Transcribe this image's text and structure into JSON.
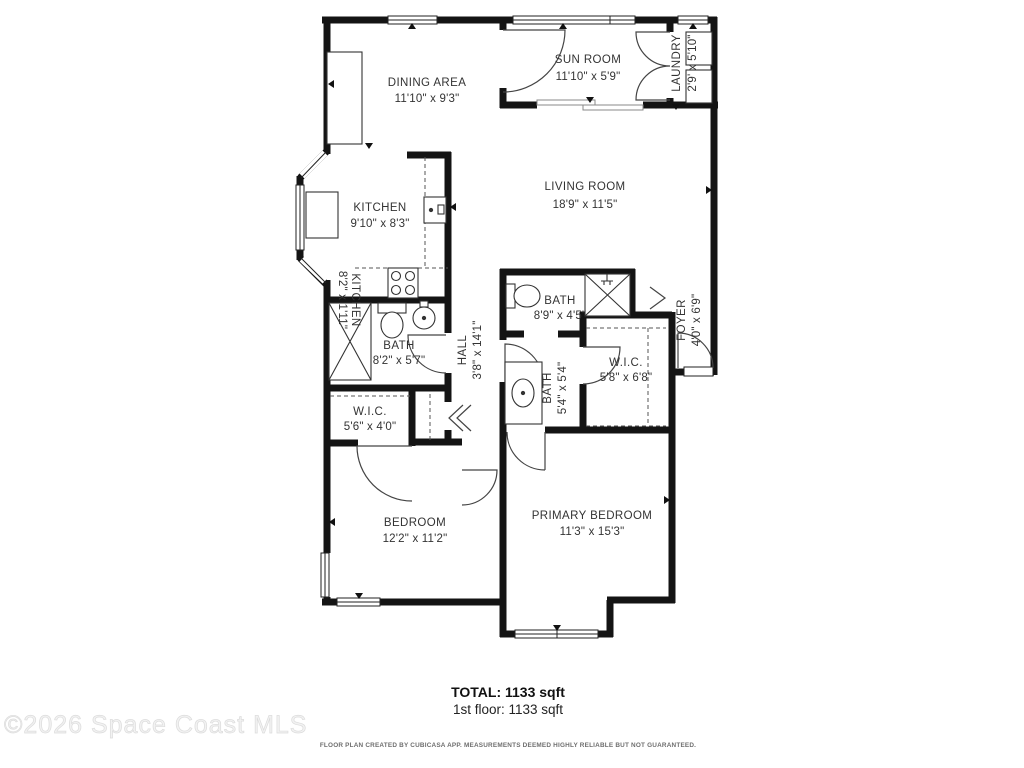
{
  "rooms": {
    "dining": {
      "name": "DINING AREA",
      "dims": "11'10\" x 9'3\""
    },
    "sunroom": {
      "name": "SUN ROOM",
      "dims": "11'10\" x 5'9\""
    },
    "laundry": {
      "name": "LAUNDRY",
      "dims": "2'9' x 5'10\""
    },
    "living": {
      "name": "LIVING ROOM",
      "dims": "18'9\" x 11'5\""
    },
    "kitchen": {
      "name": "KITCHEN",
      "dims": "9'10\" x 8'3\""
    },
    "kitchen_strip": {
      "name": "KITCHEN",
      "dims": "8'2\" x 1'11\""
    },
    "bath1": {
      "name": "BATH",
      "dims": "8'2\" x 5'7\""
    },
    "bath2": {
      "name": "BATH",
      "dims": "8'9\" x 4'5\""
    },
    "bath3": {
      "name": "BATH",
      "dims": "5'4\" x 5'4\""
    },
    "hall": {
      "name": "HALL",
      "dims": "3'8\" x 14'1\""
    },
    "foyer": {
      "name": "FOYER",
      "dims": "4'0\" x 6'9\""
    },
    "wic1": {
      "name": "W.I.C.",
      "dims": "5'6\" x 4'0\""
    },
    "wic2": {
      "name": "W.I.C.",
      "dims": "5'8\" x 6'8\""
    },
    "bedroom": {
      "name": "BEDROOM",
      "dims": "12'2\" x 11'2\""
    },
    "primary": {
      "name": "PRIMARY BEDROOM",
      "dims": "11'3\" x 15'3\""
    }
  },
  "summary": {
    "total": "TOTAL:  1133 sqft",
    "floor": "1st floor:  1133 sqft"
  },
  "footer": "FLOOR PLAN CREATED BY CUBICASA APP. MEASUREMENTS DEEMED HIGHLY RELIABLE BUT NOT GUARANTEED.",
  "watermark": "©2026 Space Coast MLS",
  "colors": {
    "wall": "#141414",
    "line": "#333333",
    "watermark": "#f2f2f2"
  }
}
